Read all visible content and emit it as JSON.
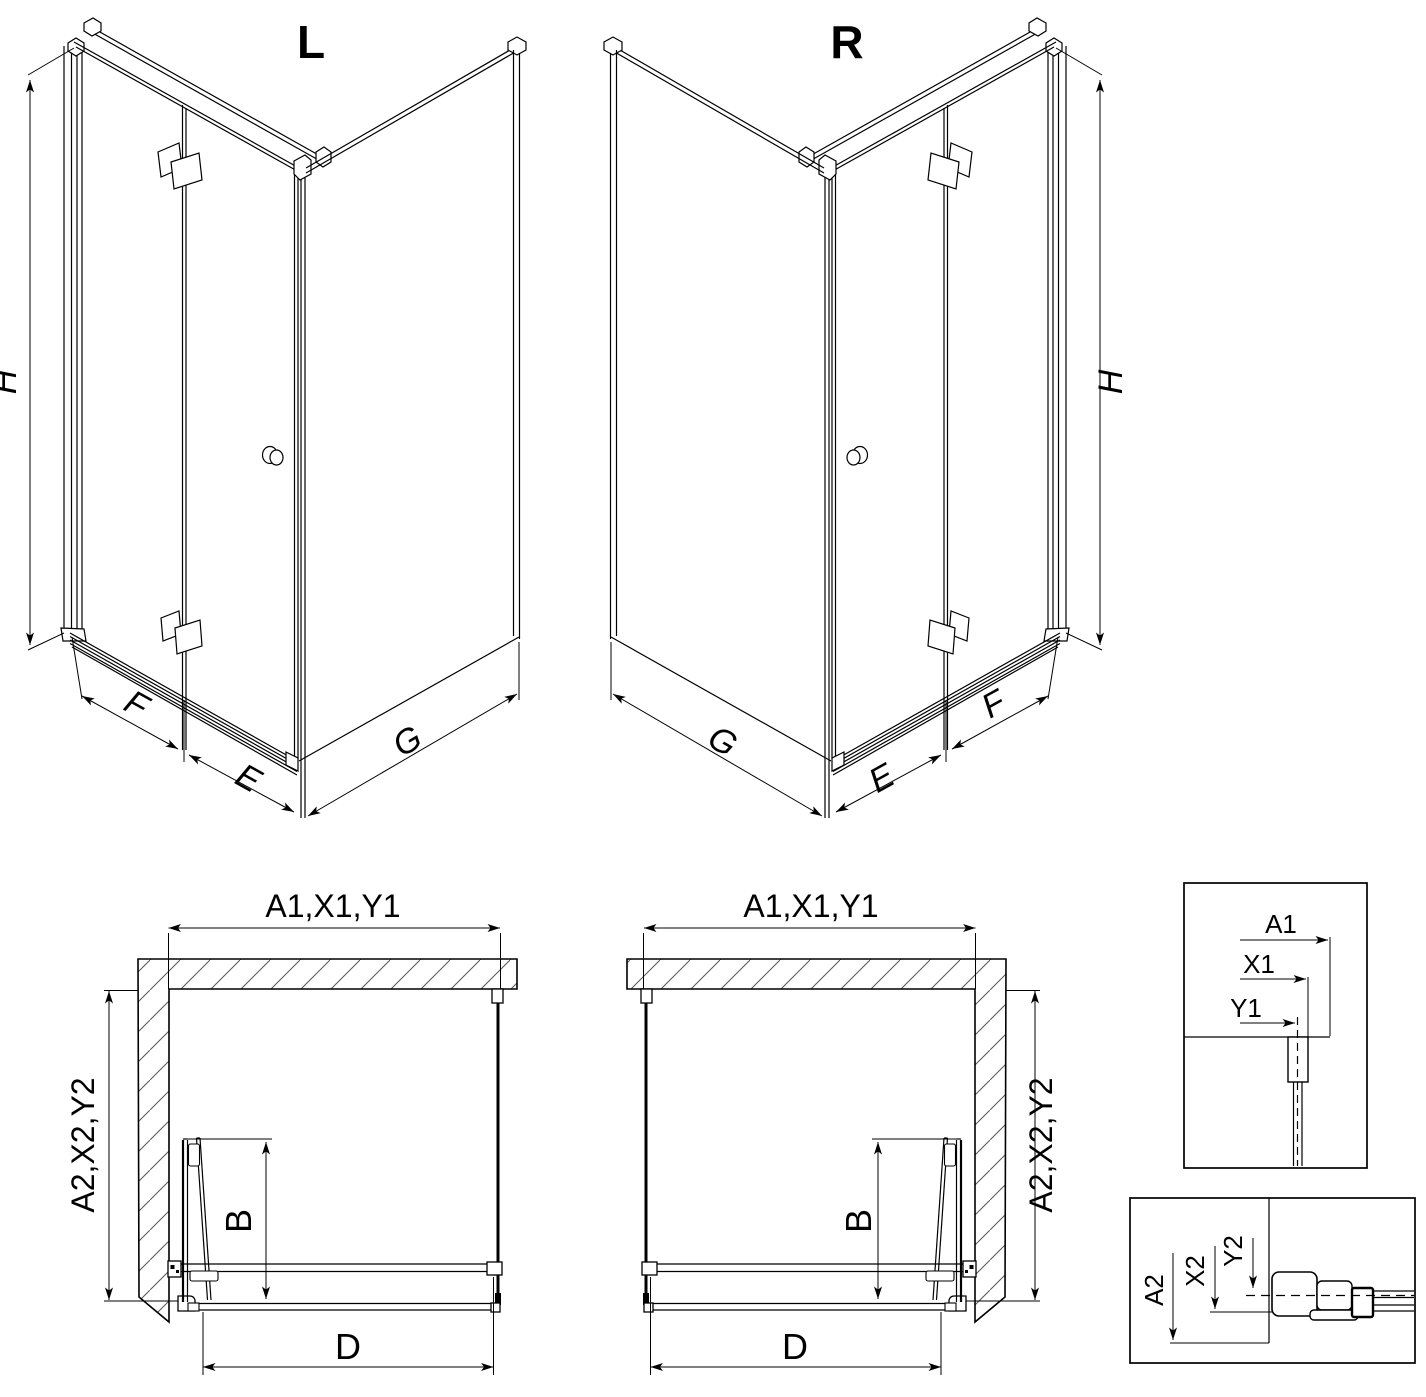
{
  "document": {
    "type": "shower-enclosure-technical-drawing",
    "colors": {
      "ink": "#000000",
      "paper": "#ffffff",
      "hatch": "#555555"
    }
  },
  "figures": {
    "iso_left": {
      "title": "L",
      "labels": {
        "height": "H",
        "panel_fixed": "F",
        "panel_door": "E",
        "side_wall": "G"
      }
    },
    "iso_right": {
      "title": "R",
      "labels": {
        "height": "H",
        "panel_fixed": "F",
        "panel_door": "E",
        "side_wall": "G"
      }
    },
    "plan_left": {
      "labels": {
        "width_top": "A1,X1,Y1",
        "depth_side": "A2,X2,Y2",
        "door_fold": "B",
        "opening": "D"
      }
    },
    "plan_right": {
      "labels": {
        "width_top": "A1,X1,Y1",
        "depth_side": "A2,X2,Y2",
        "door_fold": "B",
        "opening": "D"
      }
    },
    "detail_width": {
      "labels": {
        "a1": "A1",
        "x1": "X1",
        "y1": "Y1"
      }
    },
    "detail_depth": {
      "labels": {
        "a2": "A2",
        "x2": "X2",
        "y2": "Y2"
      }
    }
  }
}
